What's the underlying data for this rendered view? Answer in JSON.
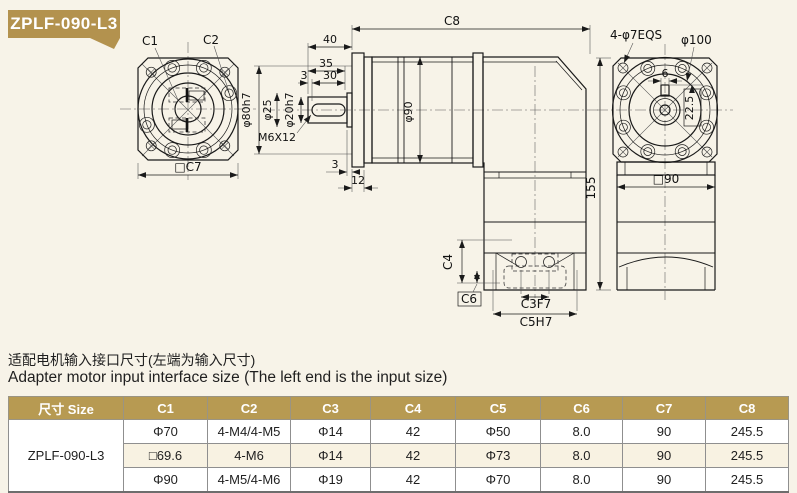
{
  "colors": {
    "background": "#f7f3e8",
    "badge_gold": "#b3924e",
    "table_header_gold": "#b79a52",
    "alt_row": "#f8f2e2",
    "line": "#1a1a1a"
  },
  "badge": {
    "label": "ZPLF-090-L3"
  },
  "drawing": {
    "front": {
      "c1": "C1",
      "c2": "C2",
      "c7": "□C7"
    },
    "side": {
      "c8": "C8",
      "d40": "40",
      "d35": "35",
      "d3": "3",
      "d30": "30",
      "d80": "φ80h7",
      "d25": "φ25",
      "d20": "φ20h7",
      "m6": "M6X12",
      "d90": "φ90",
      "gap3": "3",
      "t12": "12",
      "c4": "C4",
      "c6": "C6",
      "c3": "C3F7",
      "c5": "C5H7",
      "h155": "155"
    },
    "rear": {
      "holes": "4-φ7EQS",
      "d100": "φ100",
      "k6": "6",
      "k22": "22.5",
      "sq90": "□90"
    }
  },
  "caption": {
    "zh": "适配电机输入接口尺寸(左端为输入尺寸)",
    "en": "Adapter motor input interface size (The left end is the input size)"
  },
  "table": {
    "headers": [
      "尺寸 Size",
      "C1",
      "C2",
      "C3",
      "C4",
      "C5",
      "C6",
      "C7",
      "C8"
    ],
    "model": "ZPLF-090-L3",
    "rows": [
      [
        "Φ70",
        "4-M4/4-M5",
        "Φ14",
        "42",
        "Φ50",
        "8.0",
        "90",
        "245.5"
      ],
      [
        "□69.6",
        "4-M6",
        "Φ14",
        "42",
        "Φ73",
        "8.0",
        "90",
        "245.5"
      ],
      [
        "Φ90",
        "4-M5/4-M6",
        "Φ19",
        "42",
        "Φ70",
        "8.0",
        "90",
        "245.5"
      ]
    ]
  }
}
